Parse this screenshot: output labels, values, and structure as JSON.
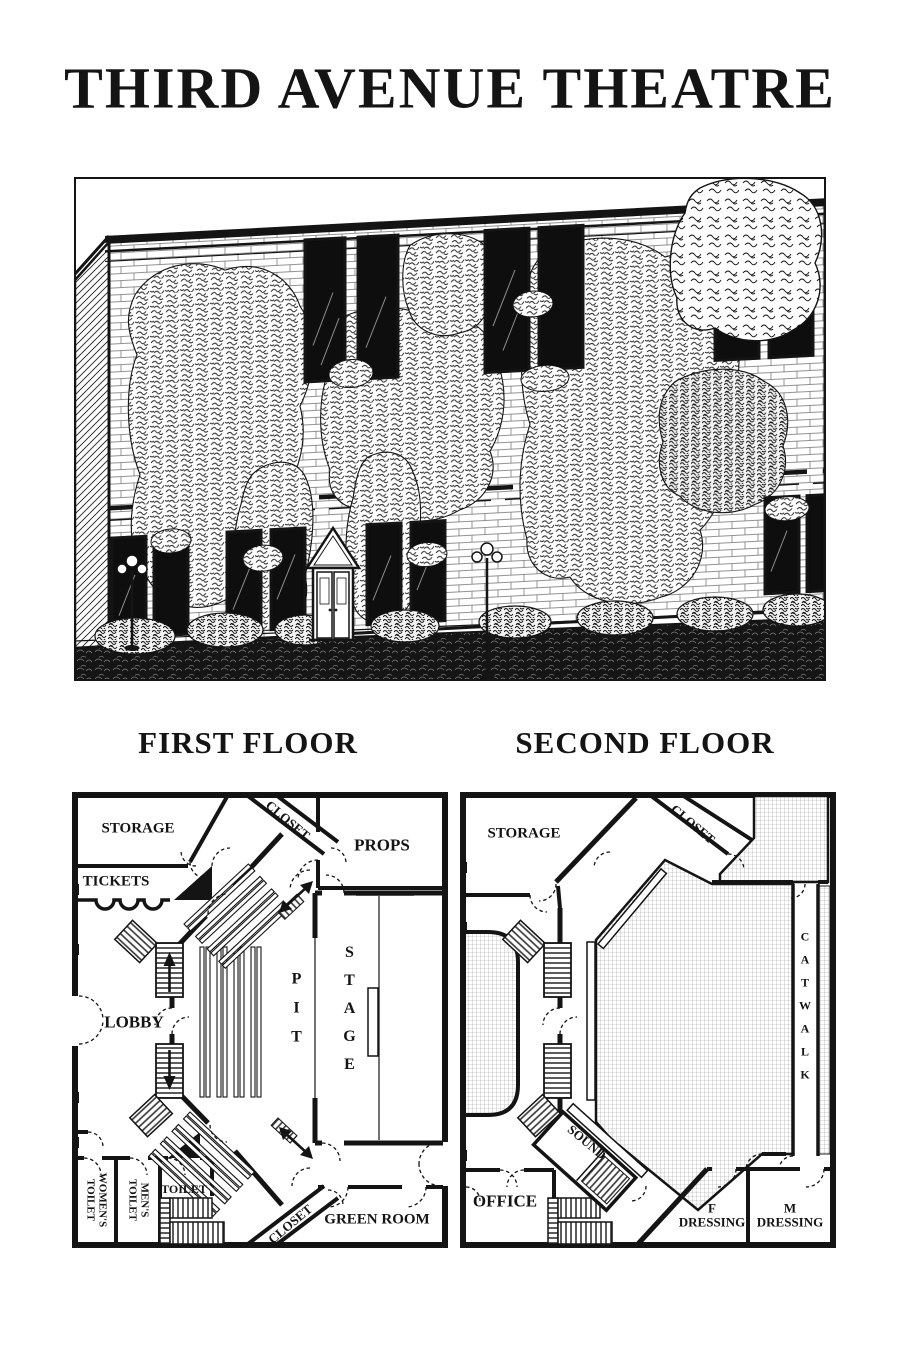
{
  "header": {
    "title": "THIRD AVENUE THEATRE"
  },
  "headings": {
    "first": "FIRST FLOOR",
    "second": "SECOND FLOOR"
  },
  "f1": {
    "storage": "STORAGE",
    "tickets": "TICKETS",
    "closet_top": "CLOSET",
    "props": "PROPS",
    "lobby": "LOBBY",
    "pit": "PIT",
    "stage": "STAGE",
    "womens_l1": "WOMEN'S",
    "womens_l2": "TOILET",
    "mens_l1": "MEN'S",
    "mens_l2": "TOILET",
    "toilet": "TOILET",
    "closet_bottom": "CLOSET",
    "green_room": "GREEN ROOM"
  },
  "f2": {
    "storage": "STORAGE",
    "closet": "CLOSET",
    "catwalk": "CATWALK",
    "sound": "SOUND",
    "office": "OFFICE",
    "f_dress_l1": "F",
    "f_dress_l2": "DRESSING",
    "m_dress_l1": "M",
    "m_dress_l2": "DRESSING"
  },
  "colors": {
    "ink": "#141414",
    "paper": "#ffffff",
    "open_hatch": "#a6a6a6"
  }
}
